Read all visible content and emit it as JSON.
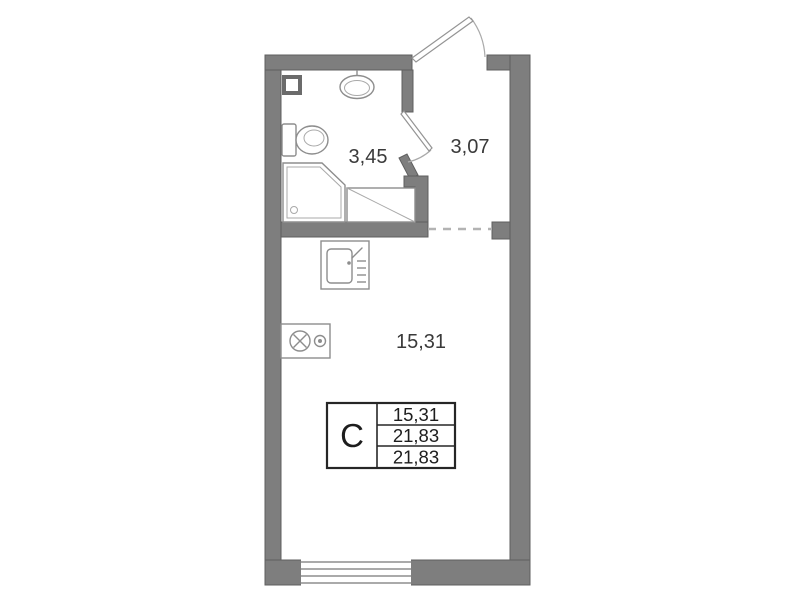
{
  "colors": {
    "wall": "#7e7e7e",
    "fixture_stroke": "#8d8d8d",
    "text": "#3a3a3a",
    "table_border": "#262626",
    "background": "#ffffff"
  },
  "areas": {
    "bathroom": "3,45",
    "hallway": "3,07",
    "room": "15,31"
  },
  "legend": {
    "type": "C",
    "rows": [
      "15,31",
      "21,83",
      "21,83"
    ]
  },
  "icons": [
    "vent-shaft-icon",
    "washbasin-icon",
    "toilet-icon",
    "shower-icon",
    "washing-machine-area-icon",
    "kitchen-sink-icon",
    "stove-icon",
    "entrance-door-icon",
    "bathroom-door-icon",
    "window-icon"
  ]
}
